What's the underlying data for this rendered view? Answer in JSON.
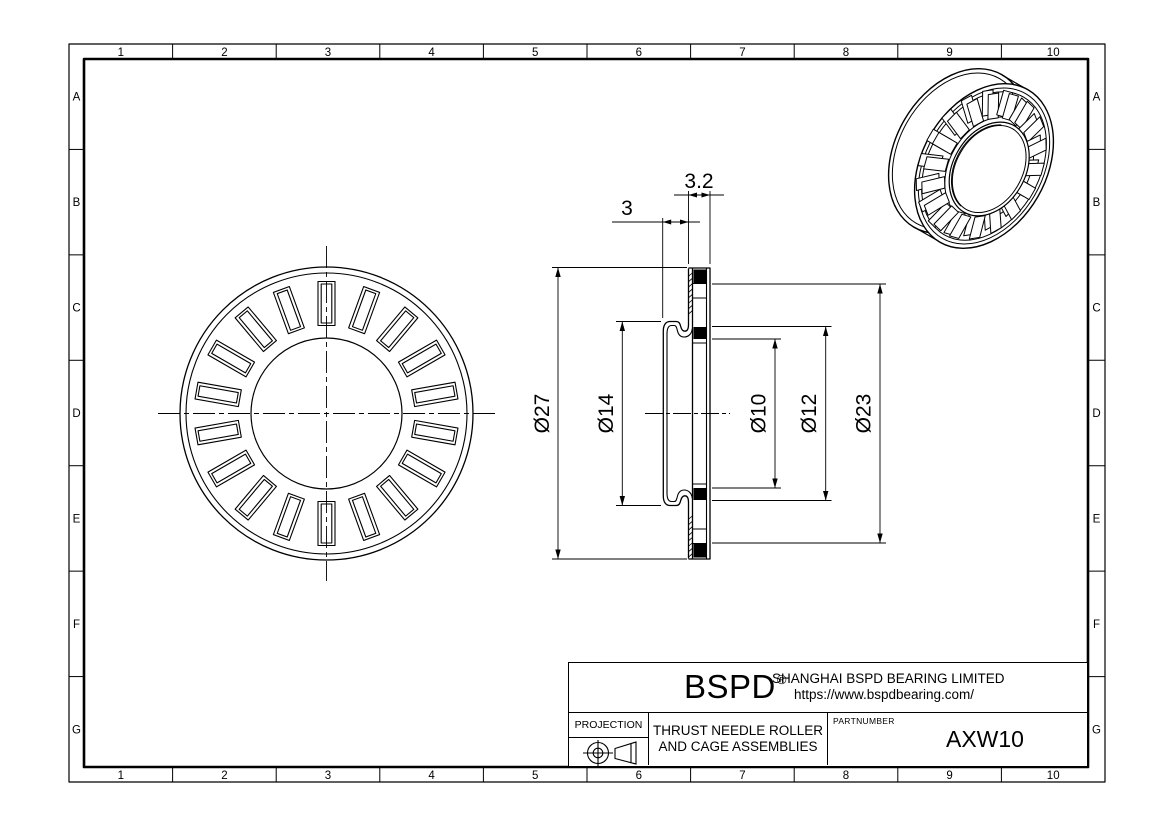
{
  "page": {
    "background": "#ffffff",
    "ink": "#000000"
  },
  "border": {
    "columns": [
      "1",
      "2",
      "3",
      "4",
      "5",
      "6",
      "7",
      "8",
      "9",
      "10"
    ],
    "rows": [
      "A",
      "B",
      "C",
      "D",
      "E",
      "F",
      "G"
    ]
  },
  "views": {
    "front_view": {
      "label": "front-view-of-bearing",
      "roller_count": 18
    },
    "section_view": {
      "label": "cross-section-view",
      "visible_roller_sections": 4
    },
    "iso_view": {
      "label": "isometric-view",
      "roller_count": 18
    }
  },
  "dimensions": {
    "cage_width": "3.2",
    "washer_width": "3",
    "outer_diameter": "Ø27",
    "washer_bore_diameter": "Ø14",
    "bore_diameter": "Ø10",
    "inner_diameter_12": "Ø12",
    "roller_ring_diameter": "Ø23"
  },
  "title_block": {
    "logo": "BSPD",
    "registered_mark": "®",
    "company": "SHANGHAI BSPD BEARING LIMITED",
    "website": "https://www.bspdbearing.com/",
    "projection_label": "PROJECTION",
    "product_line1": "THRUST NEEDLE ROLLER",
    "product_line2": "AND CAGE ASSEMBLIES",
    "partnumber_label": "PARTNUMBER",
    "partnumber": "AXW10"
  }
}
